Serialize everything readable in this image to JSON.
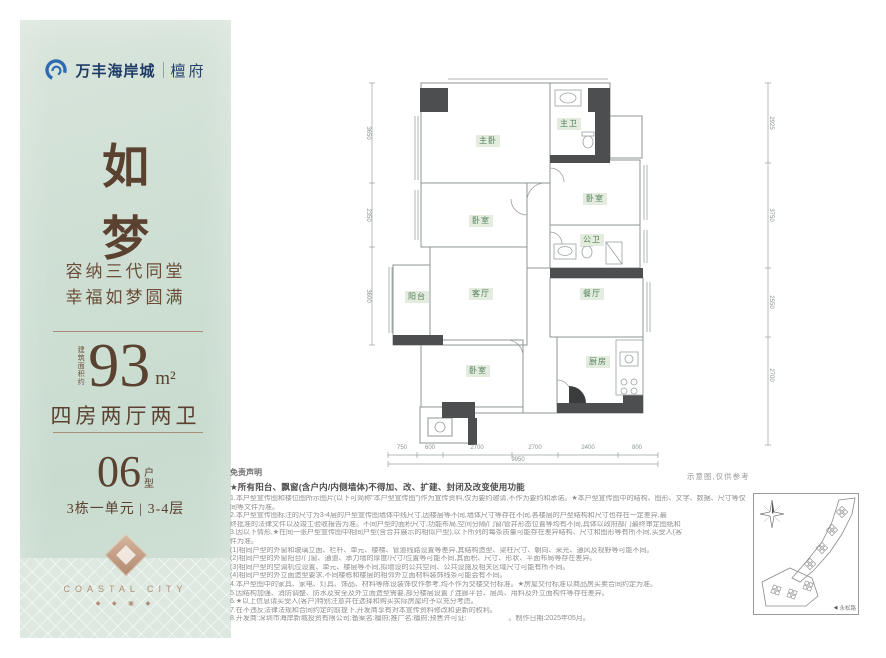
{
  "brand": {
    "name": "万丰海岸城",
    "sub": "檀府"
  },
  "panel": {
    "title_char_1": "如",
    "title_char_2": "梦",
    "slogan_line_1": "容纳三代同堂",
    "slogan_line_2": "幸福如梦圆满",
    "area_prefix": "建筑面积约",
    "area_value": "93",
    "area_unit": "m²",
    "layout_text": "四房两厅两卫",
    "unit_number": "06",
    "unit_suffix_top": "户",
    "unit_suffix_bottom": "型",
    "building_info": "3栋一单元 | 3-4层",
    "footer_brand": "COASTAL CITY",
    "ornaments": "◆ ◆ ▣ ◆"
  },
  "plan": {
    "rooms": [
      "主卧",
      "主卫",
      "卧室",
      "公卫",
      "卧室",
      "阳台",
      "客厅",
      "餐厅",
      "卧室",
      "厨房"
    ],
    "note": "示意图,仅供参考",
    "dims_bottom": [
      "750",
      "600",
      "2700",
      "2700",
      "2400",
      "800"
    ],
    "dims_bottom_total": "9950",
    "dims_right": [
      "2925",
      "3750",
      "2550",
      "2700"
    ],
    "dims_left": [
      "3650",
      "2350",
      "3600"
    ]
  },
  "disclaimer": {
    "title": "免责声明",
    "headline": "★所有阳台、飘窗(含户内/内侧墙体)不得加、改、扩建、封闭及改变使用功能",
    "lines": [
      "1.本户型宣传图和楼位图所示图片(以下可简称\"本户型宣传图\")作为宣传资料,仅为要约邀请,不作为要约和承诺。★本户型宣传图中的结构、图形、文字、数据、尺寸等仅供参考,实际交付的房屋以双方签订的商品房买卖合同及附件",
      "同等文件为准。",
      "2.本户型宣传图标注的尺寸为3-4层的户型宣传图墙体中线尺寸,因楼层等不同,墙体尺寸等存在不同,各楼层的户型结构和尺寸也存在一定差异,最",
      "终批准的法律文件以及竣工验收报告为准。不同户型的面积尺寸,功能布局,空间分隔/门窗/管井形态位置等均有不同,具体以政府部门最终审定图纸和",
      "3.因以下情形,★在同一张户型宣传图中相同户型(含合并展示的相似户型),以下所列的每条质量可能存在差异结构、尺寸和图形等有所不同,买受人(客",
      "件为准。",
      "(1)相同户型的外窗和玻璃立面、栏杆、单元、楼梯、管道线路设置等差异,其结构造型、梁柱尺寸、朝向、采光、通风及视野等可能不同。",
      "(2)相同户型的外窗阳台/门窗、通道、承力墙的厚度/尺寸/位置等可能不同,其面积、尺寸、形状、平面布局等存在差异。",
      "(3)相同户型的空调机位设置、单元、楼层等不同,拟增设的公共空间、公共设施及相关区域尺寸可能有所不同。",
      "(4)相同户型的外立面造型要求,不同楼栋和楼层的相邻外立面材料装饰线条可能会有不同。",
      "4.本户型图中的家具、家电、灯具、饰品、材料等陈设装饰仅作参考,均不作为交楼交付标准。★房屋交付标准以商品房买卖合同约定为准。",
      "5.因结构加强、消防调整、防水及安全及外立面造型需要,部分楼层设置了连廊平台、层高、用料及外立面构件等存在差异。",
      "6.★以上信息请买受人(客户)特别注意并在选择和购买实际房屋时予以充分考虑。",
      "7.在不违反法律法规和合同约定的前提下,开发商享有对本宣传资料修改和更新的权利。",
      "8.开发商:深圳市海岸新城投资有限公司;备案名:檀府;推广名:檀府;预售许可证:　　　　　　。制作日期:2025年05月。"
    ]
  },
  "siteplan": {
    "road_label": "永松路"
  }
}
